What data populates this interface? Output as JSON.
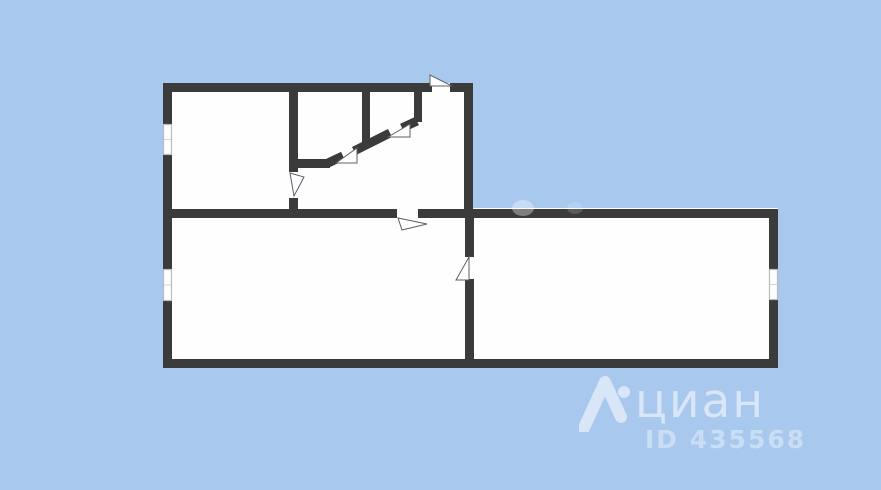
{
  "colors": {
    "background": "#a9c8ee",
    "wall": "#3b3b3b",
    "floor": "#fefefe",
    "window_frame": "#b8bcc0",
    "door_outline": "#5a6068",
    "watermark_text": "#ffffff"
  },
  "watermark": {
    "brand": "циан",
    "listing_id": "ID 435568"
  }
}
